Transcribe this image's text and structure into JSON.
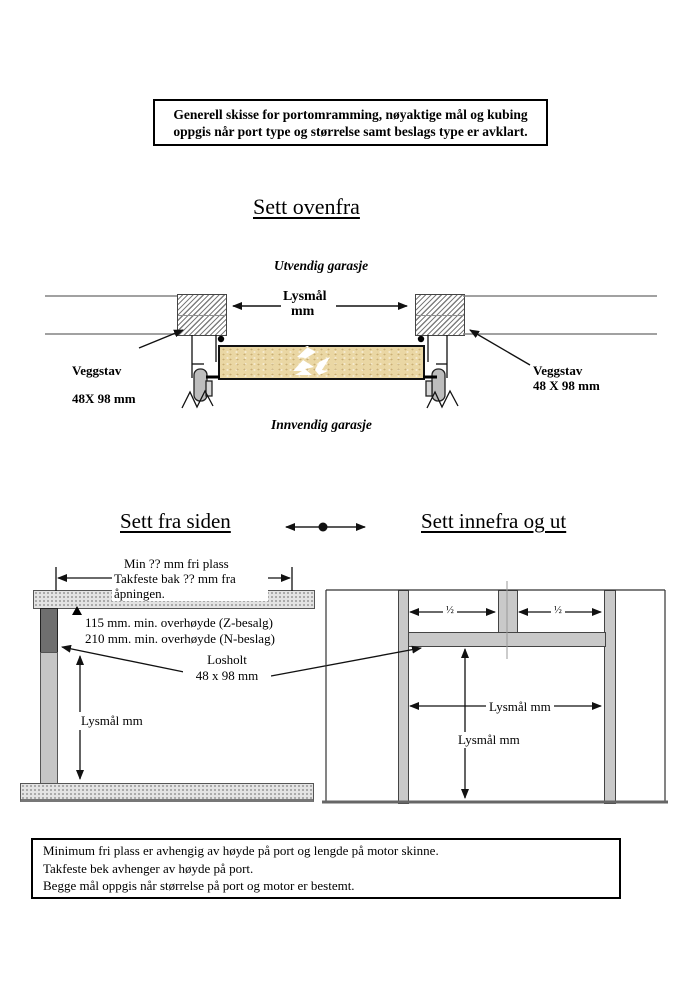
{
  "header_box": {
    "line1": "Generell skisse for portomramming, nøyaktige mål og kubing",
    "line2": "oppgis når port type og størrelse samt beslags type er avklart."
  },
  "top_view": {
    "title": "Sett ovenfra",
    "outside_label": "Utvendig garasje",
    "inside_label": "Innvendig garasje",
    "opening_width": {
      "line1": "Lysmål",
      "line2": "mm"
    },
    "left_stud": {
      "line1": "Veggstav",
      "line2": "48X 98 mm"
    },
    "right_stud": {
      "line1": "Veggstav",
      "line2": "48 X 98 mm"
    }
  },
  "side_view": {
    "title": "Sett fra siden",
    "clearance_note": {
      "line1": "Min ?? mm fri plass",
      "line2": "Takfeste bak ?? mm fra",
      "line3": "åpningen."
    },
    "headroom_note": {
      "line1": "115 mm. min. overhøyde (Z-besalg)",
      "line2": "210 mm. min. overhøyde (N-beslag)"
    },
    "lintel_note": {
      "line1": "Losholt",
      "line2": "48 x 98 mm"
    },
    "opening_height_label": "Lysmål mm"
  },
  "front_view": {
    "title": "Sett innefra og ut",
    "half_left": "½",
    "half_right": "½",
    "opening_width_label": "Lysmål mm",
    "opening_height_label": "Lysmål mm"
  },
  "footer_box": {
    "line1": "Minimum fri plass er avhengig av høyde på port og lengde på motor skinne.",
    "line2": "Takfeste bek avhenger av høyde på port.",
    "line3": "Begge mål oppgis når størrelse på port og motor er bestemt."
  },
  "colors": {
    "door_panel": "#EAD7A4",
    "post_dark": "#6F6F6F",
    "post_light": "#C6C6C6",
    "frame_gray": "#C9C9C9",
    "texture_bar": "#E3E3E3",
    "line": "#111111"
  }
}
